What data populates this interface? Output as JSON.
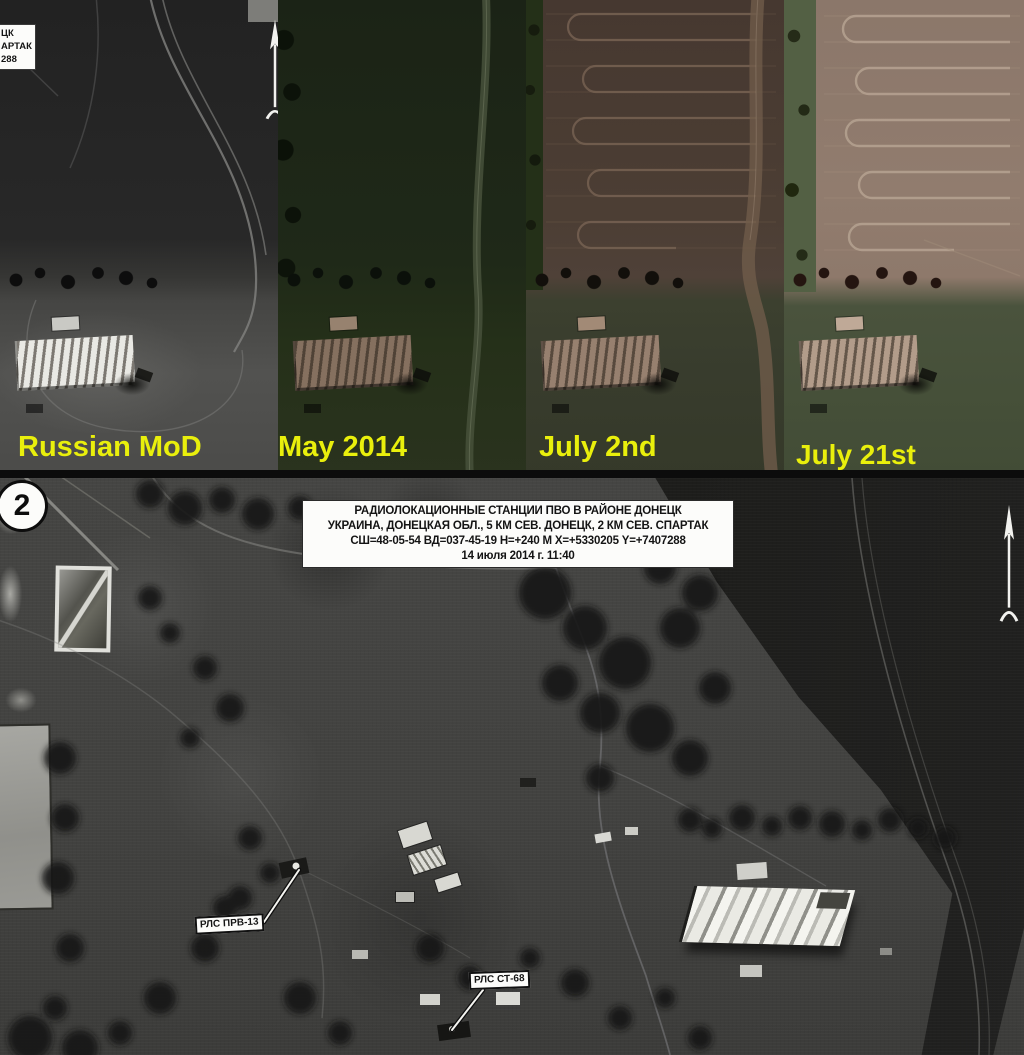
{
  "window": {
    "width": 1024,
    "height": 1055
  },
  "colors": {
    "label_yellow": "#e9ef0c",
    "annotation_bg": "#fcfcfa",
    "annotation_text": "#141414",
    "arrow_white": "#f2f2ef"
  },
  "top_row": {
    "panels": [
      {
        "id": "russian-mod",
        "label": "Russian MoD"
      },
      {
        "id": "may-2014",
        "label": "May 2014"
      },
      {
        "id": "july-2nd",
        "label": "July 2nd"
      },
      {
        "id": "july-21st",
        "label": "July 21st"
      }
    ],
    "corner_caption": {
      "line1": "ЦК",
      "line2": "АРТАК",
      "line3": "288"
    }
  },
  "main_image": {
    "marker_number": "2",
    "caption": {
      "line1": "РАДИОЛОКАЦИОННЫЕ СТАНЦИИ ПВО В РАЙОНЕ ДОНЕЦК",
      "line2": "УКРАИНА, ДОНЕЦКАЯ ОБЛ., 5 КМ СЕВ. ДОНЕЦК, 2 КМ СЕВ. СПАРТАК",
      "line3": "СШ=48-05-54 ВД=037-45-19 Н=+240 М Х=+5330205 Y=+7407288",
      "line4": "14 июля 2014 г. 11:40"
    },
    "radar_label_1": "РЛС ПРВ-13",
    "radar_label_2": "РЛС СТ-68"
  }
}
